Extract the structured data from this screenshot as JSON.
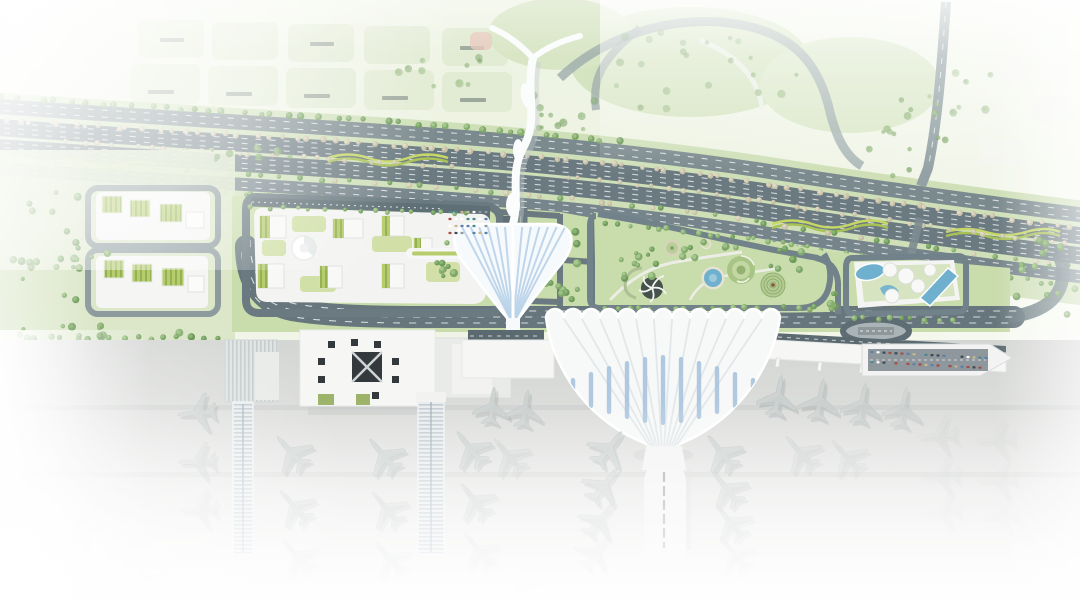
{
  "scene": {
    "title": "Airport masterplan aerial rendering",
    "type": "architectural-site-plan",
    "features": [
      "faded city blocks (north-west)",
      "landscaped expressway corridor with tree rows and wavy yellow-green berms",
      "white organic pedestrian bridge crossing the expressway",
      "office campus with green-roof blocks and round dome pavilion",
      "leaf-shaped white transit canopy with blue ribs",
      "landscape park with circular gardens, round pool and spiral mounds",
      "resort block with swimming pools and green roof deck",
      "ground transport loop and oval bus loop",
      "terminal 1: square hall with dark skylight grid and twin ribbed piers",
      "terminal 2: fan/shell roof hall with blue skylight slats",
      "center concourse with parked aircraft",
      "east pier with parking deck full of cars",
      "aircraft aprons fading to white at the edges"
    ]
  },
  "palette": {
    "wash": "#ebf1df",
    "grass": "#c9dcab",
    "grass_light": "#dbe7c6",
    "parcel": "#e0ead0",
    "road": "#6a7a80",
    "road_light": "#7b8a8e",
    "parking": "#5e6f75",
    "white_bldg": "#f6f7f5",
    "rib_blue": "#b9d2e8",
    "slat_blue": "#a9c4dd",
    "water": "#6fb0cf",
    "water_light": "#9ccadd",
    "roof_green": "#b7cc6d",
    "roof_green_dark": "#94b254",
    "stripe_yellow": "#c6d765",
    "stripe_yellow_dark": "#a9c255",
    "apron": "#d6d8d6",
    "aircraft": "#ccd2d1",
    "dark_roof": "#33393c",
    "hedge": "#6f9a5c"
  },
  "terminal_roof": {
    "bumps": 13,
    "left": 546,
    "top": 318,
    "bump_w": 18,
    "bump_r": 9,
    "tip_x": 663,
    "tip_y": 452,
    "slat_lengths": [
      14,
      24,
      36,
      48,
      58,
      66,
      70,
      66,
      58,
      48,
      36,
      24,
      14
    ]
  },
  "canopy": {
    "ribs": 13,
    "apex_x": 513,
    "apex_y": 324,
    "top_y": 227,
    "left_x": 462,
    "step": 8.6
  },
  "trees": {
    "palettes": {
      "green": [
        [
          "#6f9a5c",
          "#8fb877"
        ],
        [
          "#7ea668",
          "#a2c48c"
        ],
        [
          "#86ad70",
          "#a9cc92"
        ]
      ],
      "beige": [
        [
          "#c8bfa6",
          "#ddd6c2"
        ],
        [
          "#cdc6ab",
          "#e2dcc8"
        ],
        [
          "#c2bca0",
          "#d8d2ba"
        ]
      ]
    },
    "corridor_rows": [
      {
        "dy": 13,
        "x1": 0,
        "x2": 1075,
        "n": 78,
        "p": "beige",
        "r": 2.6
      },
      {
        "dy": 31,
        "x1": 60,
        "x2": 460,
        "n": 24,
        "p": "beige",
        "r": 2.4
      },
      {
        "dy": 31,
        "x1": 560,
        "x2": 1075,
        "n": 32,
        "p": "beige",
        "r": 2.4
      },
      {
        "dy": 52,
        "x1": 0,
        "x2": 1075,
        "n": 62,
        "p": "mix",
        "r": 2.6
      },
      {
        "dy": -10,
        "x1": 0,
        "x2": 630,
        "n": 40,
        "p": "green",
        "r": 3
      },
      {
        "dy": 71,
        "x1": 140,
        "x2": 1055,
        "n": 58,
        "p": "green",
        "r": 2.4
      }
    ],
    "rows": [
      {
        "line": [
          250,
          207,
          480,
          214
        ],
        "n": 16,
        "p": "green",
        "r": 2.2
      },
      {
        "line": [
          602,
          222,
          814,
          246
        ],
        "n": 17,
        "p": "green",
        "r": 2.4
      },
      {
        "line": [
          20,
          338,
          222,
          338
        ],
        "n": 16,
        "p": "green",
        "r": 3
      },
      {
        "line": [
          600,
          308,
          826,
          308
        ],
        "n": 19,
        "p": "green",
        "r": 2.6
      },
      {
        "line": [
          846,
          318,
          960,
          320
        ],
        "n": 9,
        "p": "green",
        "r": 2.4
      },
      {
        "line": [
          1014,
          352,
          1072,
          360
        ],
        "n": 6,
        "p": "green",
        "r": 3,
        "op": 0.5
      }
    ],
    "blobs": [
      {
        "x": 60,
        "y": 248,
        "rx": 50,
        "ry": 60,
        "n": 24,
        "p": "green"
      },
      {
        "x": 566,
        "y": 264,
        "rx": 26,
        "ry": 38,
        "n": 14,
        "p": "green"
      },
      {
        "x": 640,
        "y": 264,
        "rx": 28,
        "ry": 22,
        "n": 11,
        "p": "green"
      },
      {
        "x": 788,
        "y": 264,
        "rx": 24,
        "ry": 16,
        "n": 8,
        "p": "green"
      },
      {
        "x": 706,
        "y": 250,
        "rx": 36,
        "ry": 9,
        "n": 8,
        "p": "green"
      },
      {
        "x": 1042,
        "y": 285,
        "rx": 38,
        "ry": 50,
        "n": 16,
        "p": "green"
      },
      {
        "x": 690,
        "y": 72,
        "rx": 115,
        "ry": 45,
        "n": 22,
        "p": "green",
        "op": 0.5
      },
      {
        "x": 566,
        "y": 112,
        "rx": 55,
        "ry": 22,
        "n": 12,
        "p": "green",
        "op": 0.5
      },
      {
        "x": 905,
        "y": 140,
        "rx": 42,
        "ry": 58,
        "n": 14,
        "p": "green",
        "op": 0.6
      },
      {
        "x": 240,
        "y": 155,
        "rx": 55,
        "ry": 10,
        "n": 8,
        "p": "green",
        "op": 0.7
      },
      {
        "x": 432,
        "y": 72,
        "rx": 55,
        "ry": 28,
        "n": 10,
        "p": "green",
        "op": 0.45
      },
      {
        "x": 965,
        "y": 92,
        "rx": 38,
        "ry": 36,
        "n": 8,
        "p": "green",
        "op": 0.4
      },
      {
        "x": 1030,
        "y": 390,
        "rx": 35,
        "ry": 22,
        "n": 10,
        "p": "green",
        "op": 0.45
      },
      {
        "x": 100,
        "y": 332,
        "rx": 85,
        "ry": 9,
        "n": 10,
        "p": "green",
        "op": 0.9
      },
      {
        "x": 448,
        "y": 256,
        "rx": 15,
        "ry": 28,
        "n": 9,
        "p": "green"
      },
      {
        "x": 838,
        "y": 300,
        "rx": 13,
        "ry": 12,
        "n": 6,
        "p": "green"
      }
    ]
  },
  "parking": {
    "car_colors": [
      "#5b7fae",
      "#3f4a52",
      "#ffffff",
      "#c9b98a",
      "#a94a44",
      "#4a8a8f",
      "#8d9aa6"
    ],
    "rows": [
      {
        "line": [
          872,
          352,
          986,
          358
        ],
        "n": 20
      },
      {
        "line": [
          872,
          362,
          986,
          368
        ],
        "n": 20
      },
      {
        "line": [
          450,
          212,
          486,
          212
        ],
        "n": 7
      },
      {
        "line": [
          450,
          219,
          486,
          219
        ],
        "n": 7
      },
      {
        "line": [
          450,
          226,
          486,
          226
        ],
        "n": 7
      },
      {
        "line": [
          450,
          233,
          486,
          233
        ],
        "n": 7
      }
    ]
  },
  "aircraft": [
    [
      197,
      413,
      -95,
      0.95,
      0.8
    ],
    [
      197,
      462,
      -92,
      0.95,
      0.55
    ],
    [
      199,
      510,
      -92,
      0.95,
      0.3
    ],
    [
      291,
      452,
      -42,
      1,
      0.85
    ],
    [
      294,
      506,
      -42,
      1,
      0.6
    ],
    [
      297,
      556,
      -42,
      1,
      0.32
    ],
    [
      383,
      455,
      -40,
      1,
      0.85
    ],
    [
      386,
      508,
      -40,
      1,
      0.55
    ],
    [
      389,
      558,
      -40,
      1,
      0.3
    ],
    [
      470,
      448,
      -38,
      1,
      0.8
    ],
    [
      474,
      500,
      -38,
      1,
      0.55
    ],
    [
      478,
      550,
      -38,
      1,
      0.3
    ],
    [
      492,
      406,
      7,
      0.92,
      0.85
    ],
    [
      525,
      409,
      9,
      0.92,
      0.8
    ],
    [
      508,
      455,
      -40,
      1,
      0.5
    ],
    [
      609,
      448,
      38,
      1,
      0.85
    ],
    [
      604,
      485,
      38,
      1,
      0.75
    ],
    [
      600,
      520,
      38,
      1,
      0.5
    ],
    [
      596,
      552,
      38,
      1,
      0.28
    ],
    [
      721,
      452,
      -38,
      1,
      0.85
    ],
    [
      726,
      488,
      -38,
      1,
      0.7
    ],
    [
      730,
      522,
      -38,
      1,
      0.45
    ],
    [
      734,
      554,
      -38,
      1,
      0.25
    ],
    [
      778,
      396,
      10,
      1,
      0.85
    ],
    [
      820,
      400,
      10,
      1,
      0.8
    ],
    [
      862,
      404,
      10,
      1,
      0.7
    ],
    [
      903,
      408,
      10,
      1,
      0.55
    ],
    [
      800,
      452,
      -42,
      1,
      0.45
    ],
    [
      846,
      456,
      -42,
      1,
      0.35
    ],
    [
      938,
      436,
      -93,
      1,
      0.2
    ],
    [
      996,
      440,
      -93,
      1,
      0.16
    ],
    [
      940,
      476,
      -93,
      1,
      0.15
    ],
    [
      998,
      480,
      -93,
      1,
      0.12
    ],
    [
      942,
      512,
      -93,
      1,
      0.1
    ],
    [
      1000,
      516,
      -93,
      1,
      0.08
    ],
    [
      70,
      545,
      -92,
      1,
      0.1
    ],
    [
      150,
      580,
      -45,
      1,
      0.08
    ],
    [
      520,
      585,
      -40,
      1,
      0.08
    ]
  ]
}
